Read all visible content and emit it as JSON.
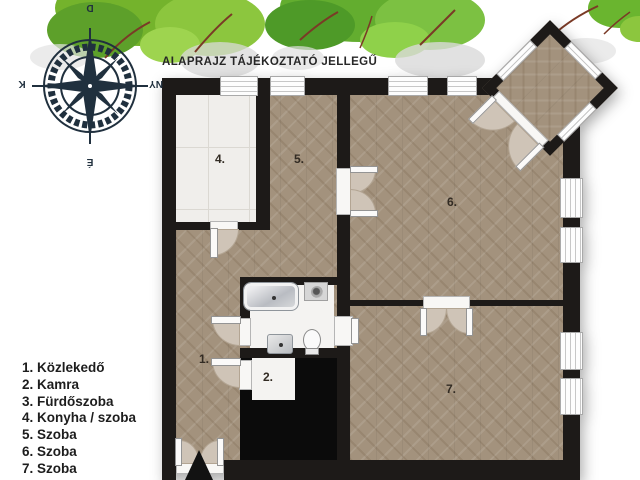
{
  "header": {
    "title": "ALAPRAJZ TÁJÉKOZTATÓ JELLEGŰ"
  },
  "compass": {
    "top": "D",
    "right": "NY",
    "bottom": "É",
    "left": "K"
  },
  "legend": {
    "items": [
      "1. Közlekedő",
      "2. Kamra",
      "3. Fürdőszoba",
      "4. Konyha / szoba",
      "5. Szoba",
      "6. Szoba",
      "7. Szoba"
    ]
  },
  "plan": {
    "room_labels": [
      {
        "num": "1.",
        "name": "Közlekedő"
      },
      {
        "num": "2.",
        "name": "Kamra"
      },
      {
        "num": "4.",
        "name": "Konyha / szoba"
      },
      {
        "num": "5.",
        "name": "Szoba"
      },
      {
        "num": "6.",
        "name": "Szoba"
      },
      {
        "num": "7.",
        "name": "Szoba"
      }
    ],
    "fixtures": [
      "bathtub",
      "water-heater",
      "washbasin",
      "toilet"
    ],
    "features": [
      "entrance-arrow",
      "double-door",
      "window",
      "bay-window",
      "compass-rose",
      "tree"
    ]
  },
  "colors": {
    "wall": "#1d1a18",
    "parquet": "#a3927d",
    "tile": "#f0eeeb",
    "void": "#0b0b0b",
    "door_arc": "#cfc4b7",
    "tree_green": "#74b32c",
    "compass_navy": "#20303e",
    "text": "#222222"
  }
}
